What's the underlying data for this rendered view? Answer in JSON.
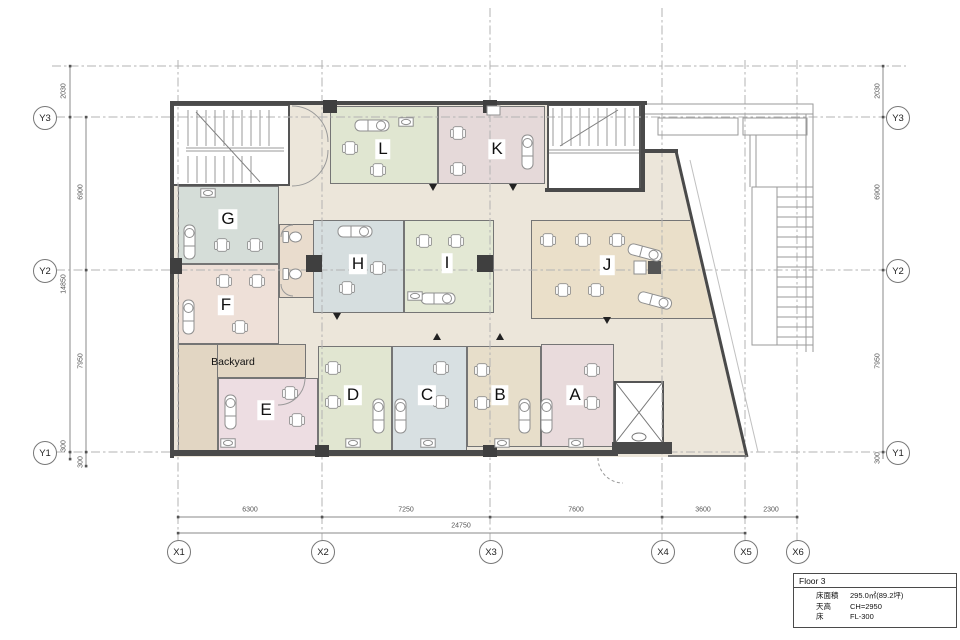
{
  "title_block": {
    "title": "Floor 3",
    "rows": [
      {
        "label": "床面積",
        "value": "295.0㎡(89.2坪)"
      },
      {
        "label": "天高",
        "value": "CH=2950"
      },
      {
        "label": "床",
        "value": "FL-300"
      }
    ]
  },
  "grid": {
    "x": [
      "X1",
      "X2",
      "X3",
      "X4",
      "X5",
      "X6"
    ],
    "y": [
      "Y3",
      "Y2",
      "Y1"
    ]
  },
  "dims": {
    "left_outer": [
      "2030",
      "14850",
      "300"
    ],
    "left_inner": [
      "6900",
      "7950",
      "300"
    ],
    "right": [
      "2030",
      "6900",
      "7950",
      "300"
    ],
    "bottom": [
      "6300",
      "7250",
      "7600",
      "3600",
      "2300"
    ],
    "bottom_total": "24750"
  },
  "rooms": {
    "A": {
      "label": "A",
      "color": "#e9dbdc"
    },
    "B": {
      "label": "B",
      "color": "#e7deca"
    },
    "C": {
      "label": "C",
      "color": "#d8e0e2"
    },
    "D": {
      "label": "D",
      "color": "#e1e6d1"
    },
    "E": {
      "label": "E",
      "color": "#eddde2"
    },
    "F": {
      "label": "F",
      "color": "#eee0d8"
    },
    "G": {
      "label": "G",
      "color": "#d5ddd8"
    },
    "H": {
      "label": "H",
      "color": "#d6dedf"
    },
    "I": {
      "label": "I",
      "color": "#e3e8d4"
    },
    "J": {
      "label": "J",
      "color": "#eadfc9"
    },
    "K": {
      "label": "K",
      "color": "#e5d9d9"
    },
    "L": {
      "label": "L",
      "color": "#e0e6d1"
    },
    "wc": {
      "label": "",
      "color": "#e9dccd"
    },
    "backyard": {
      "label": "Backyard",
      "color": "#e2d6c3"
    },
    "backyard2": {
      "label": "",
      "color": "#e2d6c3"
    }
  },
  "colors": {
    "corridor": "#ece6da",
    "wall": "#4a4a4a"
  }
}
